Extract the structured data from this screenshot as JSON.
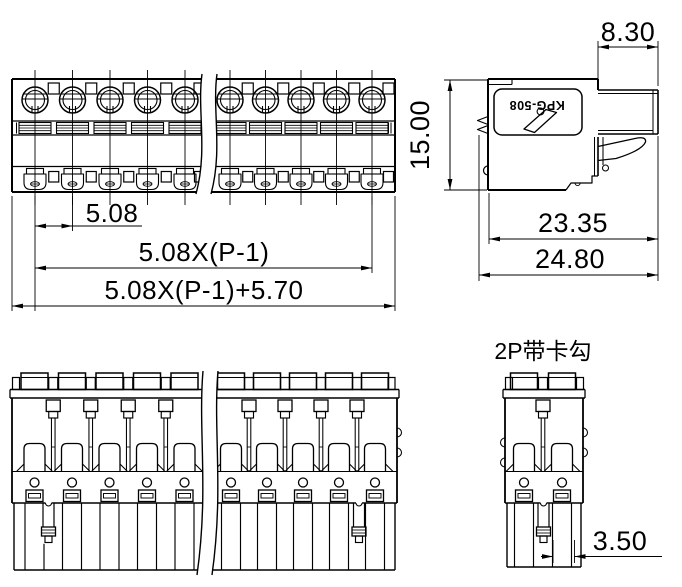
{
  "product": {
    "model": "KPG-508",
    "variant_note": "2P带卡勾"
  },
  "dimensions": {
    "pitch": "5.08",
    "pitch_span": "5.08X(P-1)",
    "overall_width": "5.08X(P-1)+5.70",
    "height": "15.00",
    "tab_width": "8.30",
    "body_depth": "23.35",
    "overall_depth": "24.80",
    "hook_width": "3.50"
  }
}
